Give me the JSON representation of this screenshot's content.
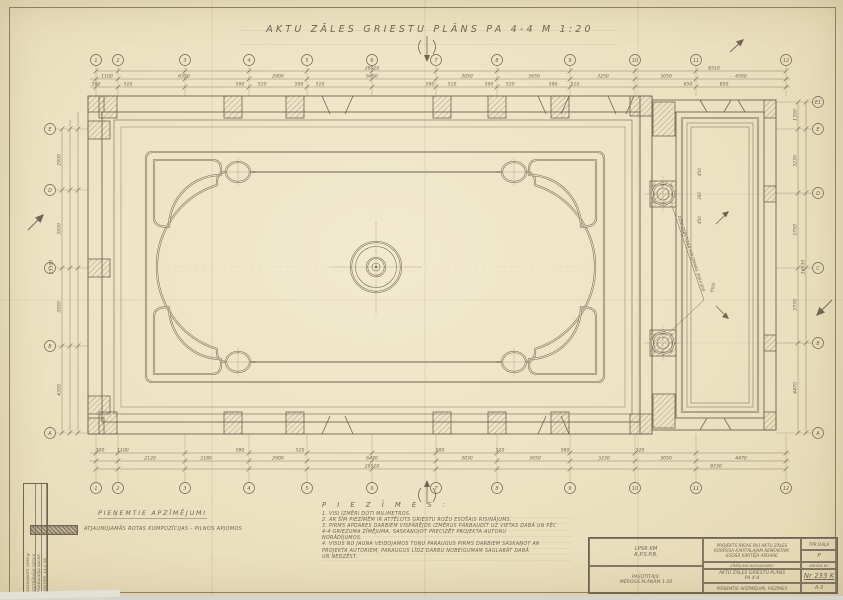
{
  "header": {
    "title": "AKTU ZĀLES GRIESTU PLĀNS PA 4-4   M 1:20",
    "section_mark": "4"
  },
  "colors": {
    "paper": "#ece2c2",
    "ink": "#6f6553"
  },
  "legend": {
    "title": "PIEŅEMTIE APZĪMĒJUMI",
    "item": "ATJAUNOJAMĀS ROTAS KOMPOZĪCIJAS - PILNOS APJOMOS"
  },
  "notes": {
    "title": "P I E Z Ī M E S :",
    "items": [
      "1. VISI IZMĒRI DOTI MILIMETROS.",
      "2. AR ŠĪM PIEZĪMĒM IR ATTĒLOTS GRIESTU ROŽU ESOŠAIS RISINĀJUMS.",
      "3. PIRMS APDARES DARBIEM VISPĀRĒJOS IZMĒRUS PĀRBAUDĪT UZ VIETAS DABĀ UN PĒC",
      "    4-4 GRIEZUMA ZĪMĒJUMA, SASKAŅOJOT PRECIZĒT PROJEKTA AUTORU",
      "    NORĀDĪJUMOS.",
      "4. VISUS NO JAUNA VEIDOJAMOS TOŅU PARAUGUS PIRMS DARBIEM SASKAŅOT AR",
      "    PROJEKTA AUTORIEM; PARAUGUS LĪDZ DARBU NOBEIGUMAM SAGLABĀT DABĀ",
      "    UN NEDZĒST."
    ]
  },
  "grid": {
    "top": {
      "y": 60,
      "cols": [
        {
          "x": 96,
          "label": "1"
        },
        {
          "x": 118,
          "label": "2"
        },
        {
          "x": 185,
          "label": "3"
        },
        {
          "x": 249,
          "label": "4"
        },
        {
          "x": 307,
          "label": "5"
        },
        {
          "x": 372,
          "label": "6"
        },
        {
          "x": 436,
          "label": "7"
        },
        {
          "x": 497,
          "label": "8"
        },
        {
          "x": 570,
          "label": "9"
        },
        {
          "x": 635,
          "label": "10"
        },
        {
          "x": 696,
          "label": "11"
        },
        {
          "x": 786,
          "label": "12"
        }
      ]
    },
    "bottom": {
      "y": 488,
      "cols": [
        {
          "x": 96,
          "label": "1"
        },
        {
          "x": 118,
          "label": "2"
        },
        {
          "x": 185,
          "label": "3"
        },
        {
          "x": 249,
          "label": "4"
        },
        {
          "x": 307,
          "label": "5"
        },
        {
          "x": 372,
          "label": "6"
        },
        {
          "x": 436,
          "label": "7"
        },
        {
          "x": 497,
          "label": "8"
        },
        {
          "x": 570,
          "label": "9"
        },
        {
          "x": 635,
          "label": "10"
        },
        {
          "x": 696,
          "label": "11"
        },
        {
          "x": 786,
          "label": "12"
        }
      ]
    },
    "left": {
      "x": 50,
      "rows": [
        {
          "y": 129,
          "label": "E"
        },
        {
          "y": 190,
          "label": "D"
        },
        {
          "y": 268,
          "label": "C"
        },
        {
          "y": 346,
          "label": "B"
        },
        {
          "y": 433,
          "label": "A"
        }
      ]
    },
    "right": {
      "x": 818,
      "rows": [
        {
          "y": 102,
          "label": "E1"
        },
        {
          "y": 129,
          "label": "E"
        },
        {
          "y": 193,
          "label": "D"
        },
        {
          "y": 268,
          "label": "C"
        },
        {
          "y": 343,
          "label": "B"
        },
        {
          "y": 433,
          "label": "A"
        }
      ]
    }
  },
  "dims": {
    "top": [
      {
        "x": 372,
        "y": 69.5,
        "t": "28010"
      },
      {
        "x": 714,
        "y": 69.5,
        "t": "8510"
      },
      {
        "x": 107,
        "y": 77.5,
        "t": "1100"
      },
      {
        "x": 184,
        "y": 77.5,
        "t": "6550"
      },
      {
        "x": 278,
        "y": 77.5,
        "t": "2900"
      },
      {
        "x": 372,
        "y": 77.5,
        "t": "6450"
      },
      {
        "x": 467,
        "y": 77.5,
        "t": "3050"
      },
      {
        "x": 534,
        "y": 77.5,
        "t": "3650"
      },
      {
        "x": 603,
        "y": 77.5,
        "t": "3250"
      },
      {
        "x": 666,
        "y": 77.5,
        "t": "3050"
      },
      {
        "x": 741,
        "y": 77.5,
        "t": "4500"
      },
      {
        "x": 96,
        "y": 85.5,
        "t": "590"
      },
      {
        "x": 128,
        "y": 85.5,
        "t": "510"
      },
      {
        "x": 240,
        "y": 85.5,
        "t": "590"
      },
      {
        "x": 262,
        "y": 85.5,
        "t": "510"
      },
      {
        "x": 299,
        "y": 85.5,
        "t": "590"
      },
      {
        "x": 320,
        "y": 85.5,
        "t": "510"
      },
      {
        "x": 430,
        "y": 85.5,
        "t": "590"
      },
      {
        "x": 452,
        "y": 85.5,
        "t": "510"
      },
      {
        "x": 489,
        "y": 85.5,
        "t": "590"
      },
      {
        "x": 510,
        "y": 85.5,
        "t": "510"
      },
      {
        "x": 553,
        "y": 85.5,
        "t": "590"
      },
      {
        "x": 575,
        "y": 85.5,
        "t": "510"
      },
      {
        "x": 688,
        "y": 85.5,
        "t": "650"
      },
      {
        "x": 724,
        "y": 85.5,
        "t": "650"
      }
    ],
    "bottom": [
      {
        "x": 100,
        "y": 451.5,
        "t": "300"
      },
      {
        "x": 123,
        "y": 451.5,
        "t": "1100"
      },
      {
        "x": 240,
        "y": 451.5,
        "t": "580"
      },
      {
        "x": 300,
        "y": 451.5,
        "t": "520"
      },
      {
        "x": 440,
        "y": 451.5,
        "t": "580"
      },
      {
        "x": 500,
        "y": 451.5,
        "t": "520"
      },
      {
        "x": 565,
        "y": 451.5,
        "t": "580"
      },
      {
        "x": 640,
        "y": 451.5,
        "t": "520"
      },
      {
        "x": 150,
        "y": 459.5,
        "t": "2120"
      },
      {
        "x": 206,
        "y": 459.5,
        "t": "3180"
      },
      {
        "x": 278,
        "y": 459.5,
        "t": "2900"
      },
      {
        "x": 372,
        "y": 459.5,
        "t": "6470"
      },
      {
        "x": 467,
        "y": 459.5,
        "t": "3030"
      },
      {
        "x": 535,
        "y": 459.5,
        "t": "3650"
      },
      {
        "x": 604,
        "y": 459.5,
        "t": "3230"
      },
      {
        "x": 666,
        "y": 459.5,
        "t": "3050"
      },
      {
        "x": 741,
        "y": 459.5,
        "t": "4470"
      },
      {
        "x": 372,
        "y": 467.5,
        "t": "29510"
      },
      {
        "x": 716,
        "y": 467.5,
        "t": "8530"
      }
    ],
    "left": [
      {
        "x": 60.5,
        "y": 160,
        "t": "2900",
        "r": -90
      },
      {
        "x": 60.5,
        "y": 229,
        "t": "3950",
        "r": -90
      },
      {
        "x": 60.5,
        "y": 307,
        "t": "3950",
        "r": -90
      },
      {
        "x": 60.5,
        "y": 390,
        "t": "4350",
        "r": -90
      },
      {
        "x": 52.5,
        "y": 267,
        "t": "15300",
        "r": -90
      }
    ],
    "right": [
      {
        "x": 796.5,
        "y": 115,
        "t": "1350",
        "r": -90
      },
      {
        "x": 796.5,
        "y": 161,
        "t": "3230",
        "r": -90
      },
      {
        "x": 796.5,
        "y": 230,
        "t": "3750",
        "r": -90
      },
      {
        "x": 796.5,
        "y": 305,
        "t": "3730",
        "r": -90
      },
      {
        "x": 796.5,
        "y": 388,
        "t": "4470",
        "r": -90
      },
      {
        "x": 804.5,
        "y": 267,
        "t": "16530",
        "r": -90
      }
    ],
    "inner": [
      {
        "x": 701,
        "y": 172,
        "t": "450",
        "r": -90,
        "s": 4
      },
      {
        "x": 701,
        "y": 196,
        "t": "300",
        "r": -90,
        "s": 4
      },
      {
        "x": 701,
        "y": 220,
        "t": "450",
        "r": -90,
        "s": 4
      },
      {
        "x": 714,
        "y": 288,
        "t": "4500",
        "r": -73,
        "s": 4
      }
    ]
  },
  "annex": {
    "column_label": "DZELZSBETONA KOLONNAS 300×300"
  },
  "stamp": {
    "rows": [
      "SASKAŅOTS 1958.g.",
      "IZSTRĀDĀJA  OZOLS",
      "PĀRBAUDĪJA  KALNS",
      "APSTIPR. 14.V 58."
    ]
  },
  "titleblock": {
    "org_line1": "LPSR KM",
    "org_line2": "R.P.S.P.B.",
    "client_line1": "PASŪTĪTĀJS:",
    "client_line2": "MĒROGS PLĀNAM 1:20",
    "project_line1": "PROJEKTS RĪGAS PILĪ AKTU ZĀLES",
    "project_line2": "KORPUSA KAPITĀLAJAM REMONTAM,",
    "project_line3": "ESOŠĀ KĀRTĒJĀ APDARE",
    "name_label": "ZĪMĒJUMA NOSAUKUMS:",
    "sheet_title_line1": "AKTU ZĀLES GRIESTU PLĀNS",
    "sheet_title_line2": "PA 4-4",
    "sheet_subtitle": "PIEŅEMTIE APZĪMĒJUMI, PIEZĪMES",
    "stage_label": "TPR DAĻA",
    "stage_value": "P",
    "archive_label": "ARHĪVA Nr.",
    "number": "Nr 233 K",
    "format": "A-3"
  }
}
